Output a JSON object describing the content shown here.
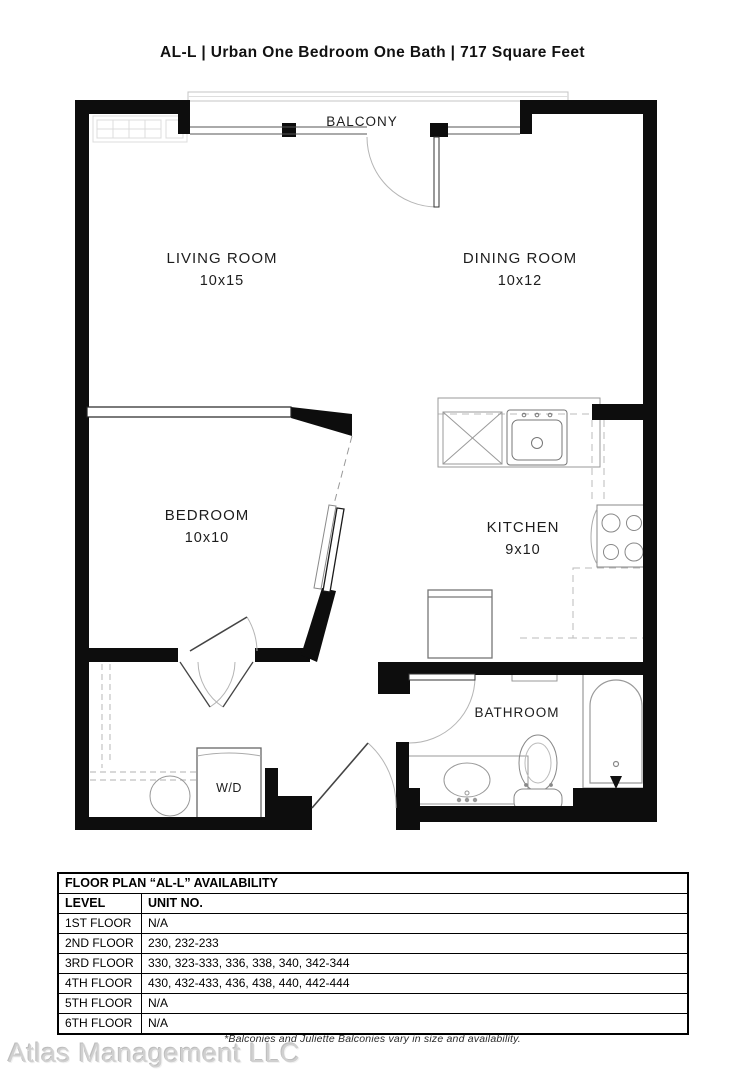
{
  "title": "AL-L | Urban One Bedroom One Bath | 717  Square Feet",
  "colors": {
    "wall": "#0d0d0d",
    "fixture_line": "#909090",
    "watermark": "#d0d0d0"
  },
  "floor_plan": {
    "rooms": [
      {
        "name": "BALCONY",
        "dims": ""
      },
      {
        "name": "LIVING ROOM",
        "dims": "10x15"
      },
      {
        "name": "DINING ROOM",
        "dims": "10x12"
      },
      {
        "name": "BEDROOM",
        "dims": "10x10"
      },
      {
        "name": "KITCHEN",
        "dims": "9x10"
      },
      {
        "name": "BATHROOM",
        "dims": ""
      },
      {
        "name": "W/D",
        "dims": ""
      }
    ]
  },
  "availability_table": {
    "title": "FLOOR PLAN “AL-L” AVAILABILITY",
    "columns": [
      "LEVEL",
      "UNIT NO."
    ],
    "rows": [
      [
        "1ST FLOOR",
        "N/A"
      ],
      [
        "2ND FLOOR",
        "230, 232-233"
      ],
      [
        "3RD FLOOR",
        "330, 323-333, 336, 338, 340, 342-344"
      ],
      [
        "4TH FLOOR",
        "430, 432-433, 436, 438, 440, 442-444"
      ],
      [
        "5TH FLOOR",
        "N/A"
      ],
      [
        "6TH FLOOR",
        "N/A"
      ]
    ]
  },
  "footer": {
    "watermark": "Atlas Management LLC",
    "note": "*Balconies and Juliette Balconies vary in size and availability."
  }
}
